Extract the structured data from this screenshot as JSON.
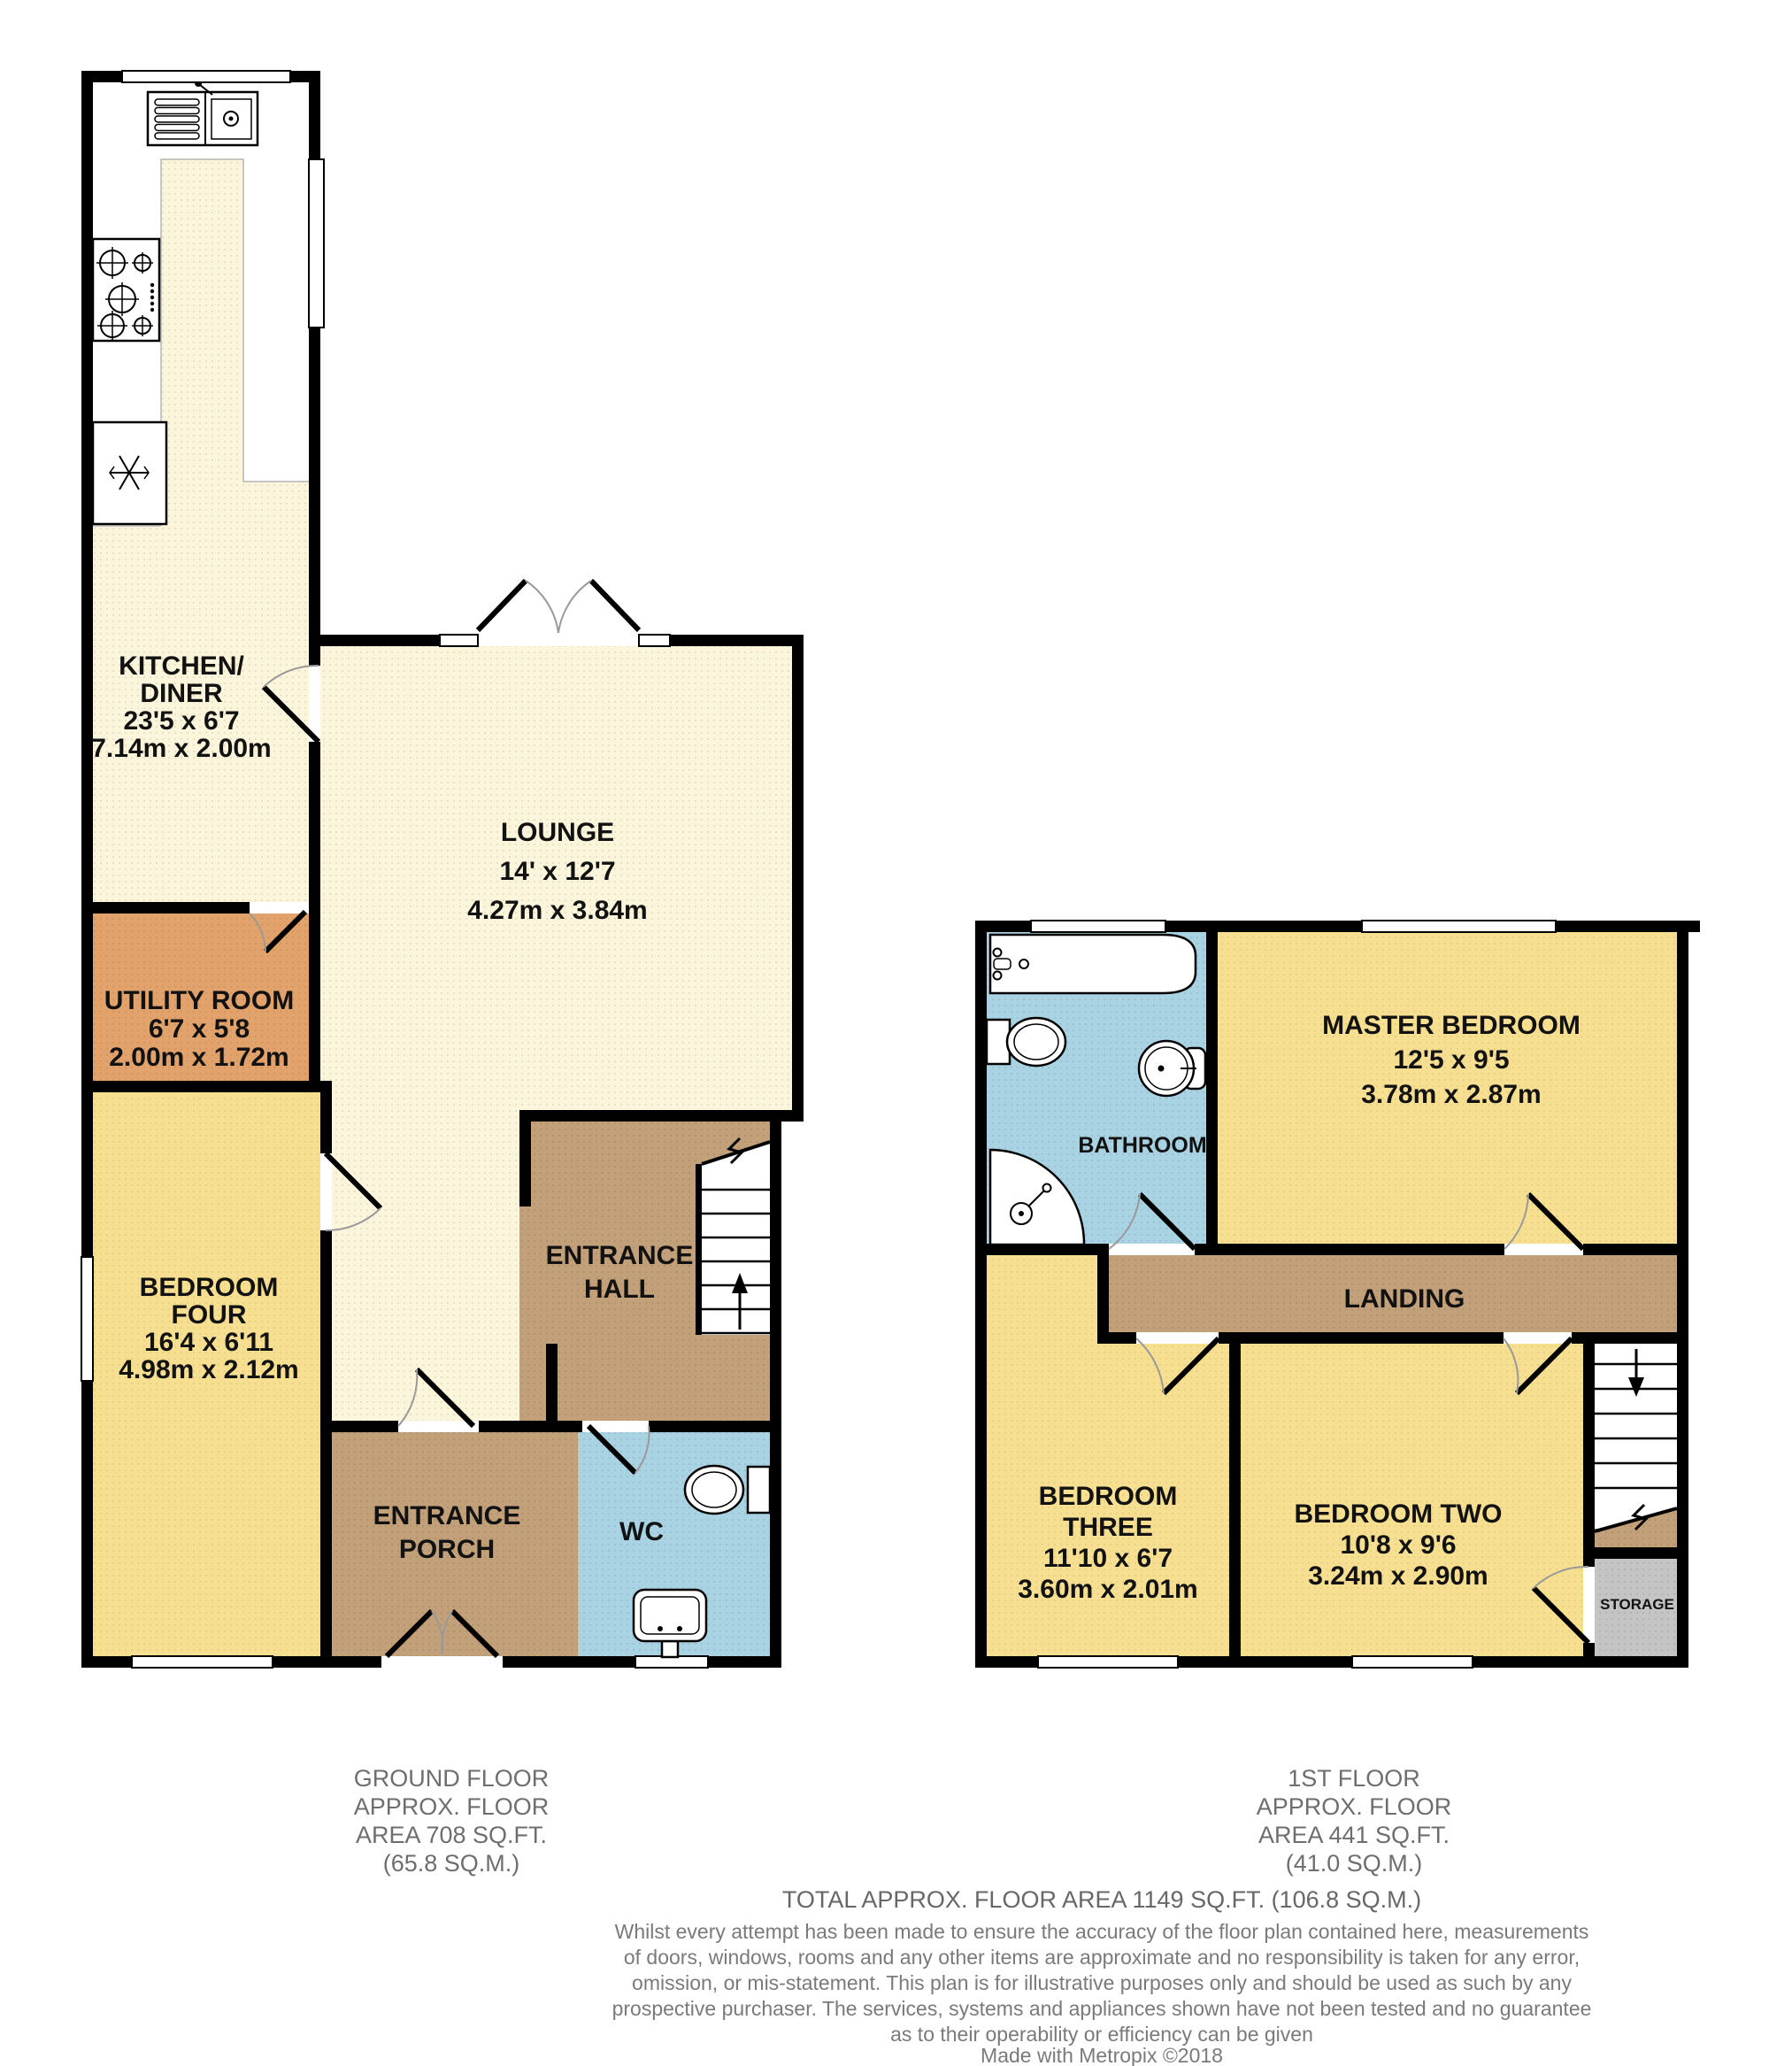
{
  "palette": {
    "cream": "#FBF5DB",
    "yellow": "#F6DF91",
    "orange": "#E1A26C",
    "brown": "#C2A07A",
    "blue": "#A9D3E2",
    "gray": "#C4C4C4",
    "wall": "#000000",
    "label_text": "#121212",
    "footer_text": "#6E6E6E"
  },
  "ground": {
    "rooms": {
      "kitchen": {
        "name_lines": [
          "KITCHEN/",
          "DINER"
        ],
        "dims_imperial": "23'5 x 6'7",
        "dims_metric": "7.14m x 2.00m"
      },
      "lounge": {
        "name": "LOUNGE",
        "dims_imperial": "14' x 12'7",
        "dims_metric": "4.27m x 3.84m"
      },
      "utility": {
        "name": "UTILITY ROOM",
        "dims_imperial": "6'7 x 5'8",
        "dims_metric": "2.00m x 1.72m"
      },
      "bedroom_four": {
        "name_lines": [
          "BEDROOM",
          "FOUR"
        ],
        "dims_imperial": "16'4 x 6'11",
        "dims_metric": "4.98m x 2.12m"
      },
      "entrance_hall": {
        "name_lines": [
          "ENTRANCE",
          "HALL"
        ]
      },
      "entrance_porch": {
        "name_lines": [
          "ENTRANCE",
          "PORCH"
        ]
      },
      "wc": {
        "name": "WC"
      }
    },
    "caption_lines": [
      "GROUND FLOOR",
      "APPROX. FLOOR",
      "AREA 708 SQ.FT.",
      "(65.8 SQ.M.)"
    ]
  },
  "first": {
    "rooms": {
      "master": {
        "name": "MASTER BEDROOM",
        "dims_imperial": "12'5 x 9'5",
        "dims_metric": "3.78m x 2.87m"
      },
      "bathroom": {
        "name": "BATHROOM"
      },
      "landing": {
        "name": "LANDING"
      },
      "bedroom_three": {
        "name_lines": [
          "BEDROOM",
          "THREE"
        ],
        "dims_imperial": "11'10 x 6'7",
        "dims_metric": "3.60m x 2.01m"
      },
      "bedroom_two": {
        "name": "BEDROOM TWO",
        "dims_imperial": "10'8 x 9'6",
        "dims_metric": "3.24m x 2.90m"
      },
      "storage": {
        "name": "STORAGE"
      }
    },
    "caption_lines": [
      "1ST FLOOR",
      "APPROX. FLOOR",
      "AREA 441 SQ.FT.",
      "(41.0 SQ.M.)"
    ]
  },
  "footer": {
    "total": "TOTAL APPROX. FLOOR AREA 1149 SQ.FT. (106.8 SQ.M.)",
    "disclaimer_lines": [
      "Whilst every attempt has been made to ensure the accuracy of the floor plan contained here, measurements",
      "of doors, windows, rooms and any other items are approximate and no responsibility is taken for any error,",
      "omission, or mis-statement. This plan is for illustrative purposes only and should be used as such by any",
      "prospective purchaser. The services, systems and appliances shown have not been tested and no guarantee",
      "as to their operability or efficiency can be given"
    ],
    "credit": "Made with Metropix ©2018"
  }
}
